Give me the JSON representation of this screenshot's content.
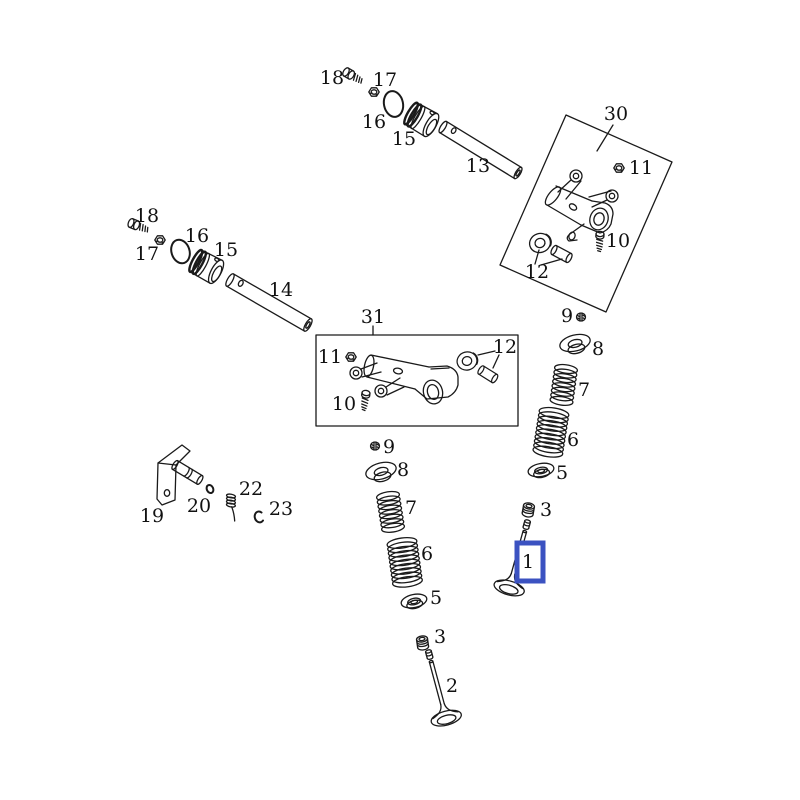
{
  "diagram": {
    "description": "Exploded parts diagram of an engine valve train (valves, springs, retainers, rocker arms and shafts)",
    "background": "#ffffff",
    "line_color": "#1a1a1a",
    "highlight_color": "#3b52c1",
    "highlighted_part": "1"
  },
  "callouts": {
    "t18": "18",
    "t17": "17",
    "t16": "16",
    "t15": "15",
    "t13": "13",
    "b30": "30",
    "b30_11": "11",
    "b30_10": "10",
    "b30_12": "12",
    "l18": "18",
    "l17": "17",
    "l16": "16",
    "l15": "15",
    "l14": "14",
    "b31": "31",
    "b31_11": "11",
    "b31_12": "12",
    "b31_10": "10",
    "r9": "9",
    "r8": "8",
    "r7": "7",
    "r6": "6",
    "r5": "5",
    "c9": "9",
    "c8": "8",
    "c7": "7",
    "c6": "6",
    "c5": "5",
    "p19": "19",
    "p20": "20",
    "p22": "22",
    "p23": "23",
    "v1_3": "3",
    "v1_1": "1",
    "v2_3": "3",
    "v2_2": "2"
  }
}
